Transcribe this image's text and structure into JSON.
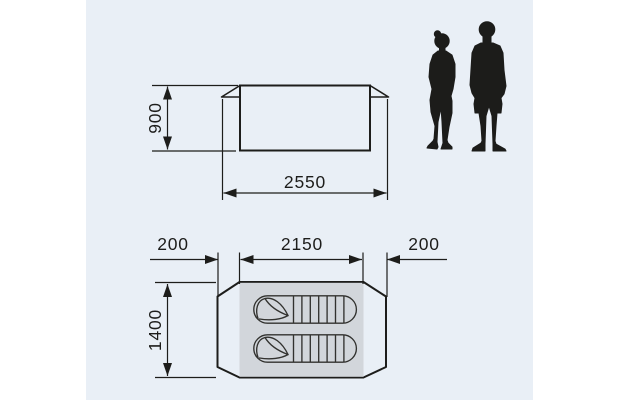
{
  "title": "Tent dimension drawing with two figures for scale",
  "colors": {
    "page_bg": "#ffffff",
    "panel_bg": "#e9eff6",
    "line": "#1d1d1b",
    "shape_fill": "#d2d6db",
    "shape_white": "#fbfcfd",
    "silhouette": "#1c1c1a"
  },
  "side_view": {
    "name": "side elevation of tent",
    "height": "900",
    "width": "2550"
  },
  "floor_plan": {
    "name": "floor plan of tent",
    "porch_left": "200",
    "inner_length": "2150",
    "porch_right": "200",
    "width": "1400",
    "contents": [
      "sleeping-bag",
      "sleeping-bag"
    ]
  },
  "scale_reference": {
    "left_figure": "woman silhouette",
    "right_figure": "man silhouette"
  }
}
